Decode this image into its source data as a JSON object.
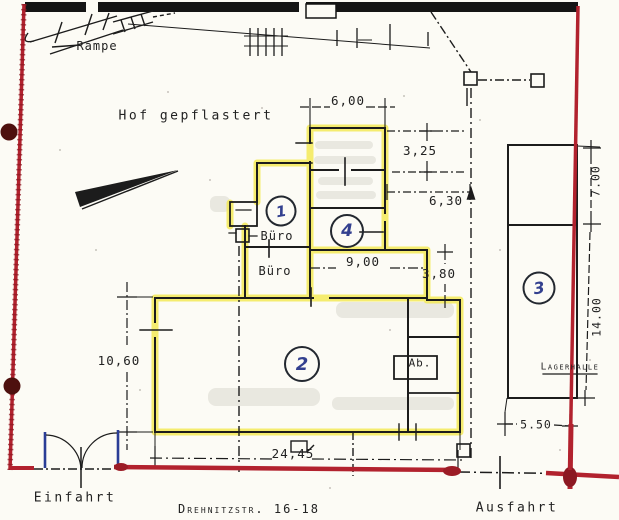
{
  "plan": {
    "area_labels": {
      "rampe": "Rampe",
      "hof": "Hof gepflastert",
      "buero_1": "Büro",
      "buero_2": "Büro",
      "ab": "Ab.",
      "lagerhalle": "Lagerhalle",
      "einfahrt": "Einfahrt",
      "ausfahrt": "Ausfahrt",
      "street": "Drehnitzstr. 16-18"
    },
    "room_numbers": {
      "r1": "1",
      "r2": "2",
      "r3": "3",
      "r4": "4"
    },
    "dimensions": {
      "top_width": "6,00",
      "upper_right_depth": "3,25",
      "east_gap": "6,30",
      "corridor_width": "9,00",
      "corridor_depth": "3,80",
      "hall_depth": "10,60",
      "hall_width": "24,45",
      "lager_top": "7.00",
      "lager_main": "14.00",
      "lager_bottom": "5.50"
    },
    "colors": {
      "boundary_red": "#b2222e",
      "highlight_yellow": "#f2e94e",
      "ink_black": "#1c1c1c",
      "pen_blue": "#2f3f96"
    }
  }
}
